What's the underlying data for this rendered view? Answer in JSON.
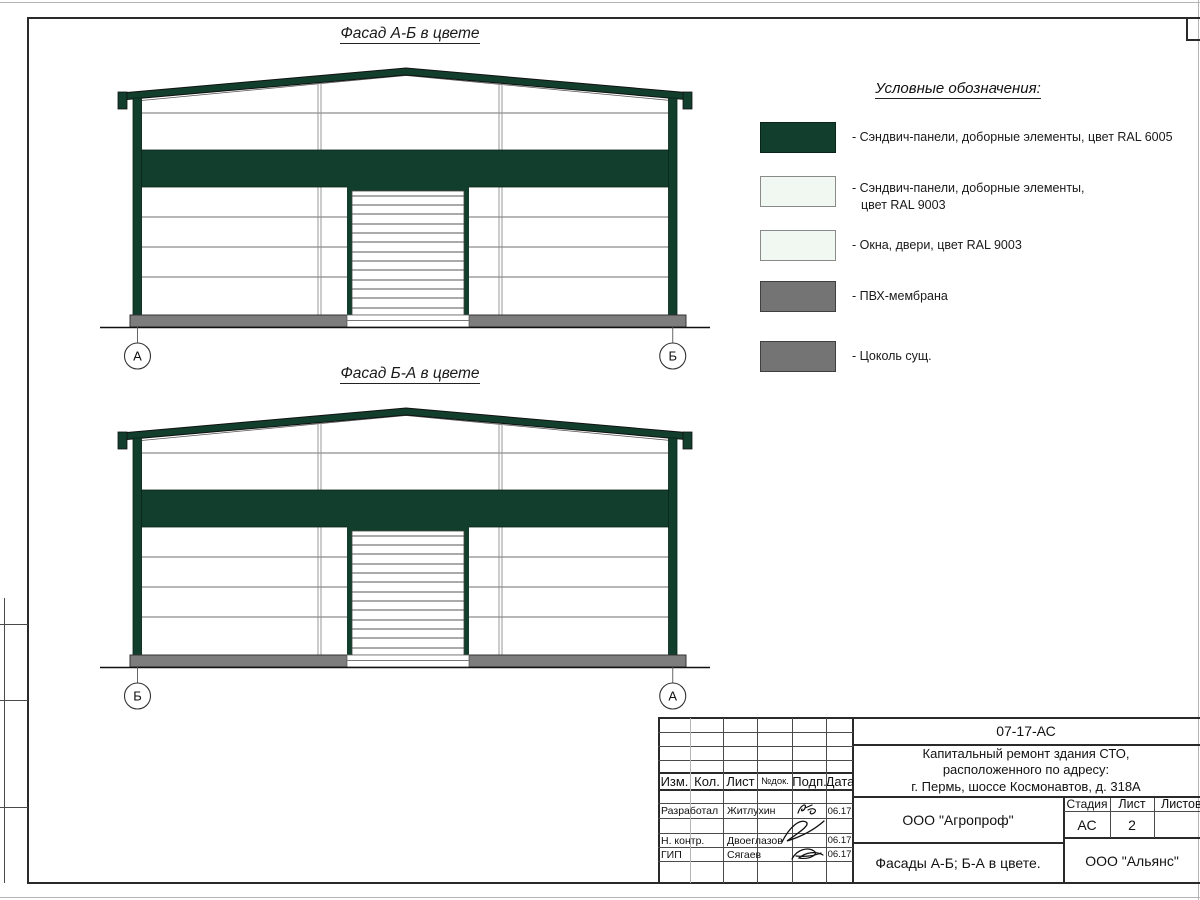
{
  "facades": [
    {
      "title": "Фасад А-Б в цвете",
      "axis_left": "А",
      "axis_right": "Б"
    },
    {
      "title": "Фасад Б-А в цвете",
      "axis_left": "Б",
      "axis_right": "А"
    }
  ],
  "legend": {
    "title": "Условные обозначения:",
    "items": [
      {
        "name": "sandwich-panels-ral6005",
        "color": "#123e2d",
        "label": "- Сэндвич-панели, доборные элементы,  цвет RAL 6005"
      },
      {
        "name": "sandwich-panels-ral9003",
        "color": "#f1f7f1",
        "label": "- Сэндвич-панели, доборные элементы,",
        "label2": "цвет RAL 9003"
      },
      {
        "name": "windows-doors-ral9003",
        "color": "#f1f7f1",
        "label": "- Окна, двери, цвет RAL 9003"
      },
      {
        "name": "pvc-membrane",
        "color": "#747474",
        "label": "- ПВХ-мембрана"
      },
      {
        "name": "existing-plinth",
        "color": "#747474",
        "label": "- Цоколь сущ."
      }
    ]
  },
  "title_block": {
    "doc_code": "07-17-АС",
    "project_line1": "Капитальный ремонт здания СТО,",
    "project_line2": "расположенного по адресу:",
    "project_line3": "г. Пермь, шоссе Космонавтов, д. 318А",
    "col_izm": "Изм.",
    "col_kol": "Кол.",
    "col_list": "Лист",
    "col_doc": "№док.",
    "col_podp": "Подп.",
    "col_data": "Дата",
    "rows": [
      {
        "role": "Разработал",
        "name": "Житлухин",
        "date": "06.17"
      },
      {
        "role": "Н. контр.",
        "name": "Двоеглазов",
        "date": "06.17"
      },
      {
        "role": "ГИП",
        "name": "Сягаев",
        "date": "06.17"
      }
    ],
    "org_top": "ООО \"Агропроф\"",
    "sheet_name": "Фасады А-Б; Б-А в цвете.",
    "org_bottom": "ООО \"Альянс\"",
    "stage_label": "Стадия",
    "list_label": "Лист",
    "listov_label": "Листов",
    "stage_value": "АС",
    "list_value": "2",
    "listov_value": ""
  }
}
